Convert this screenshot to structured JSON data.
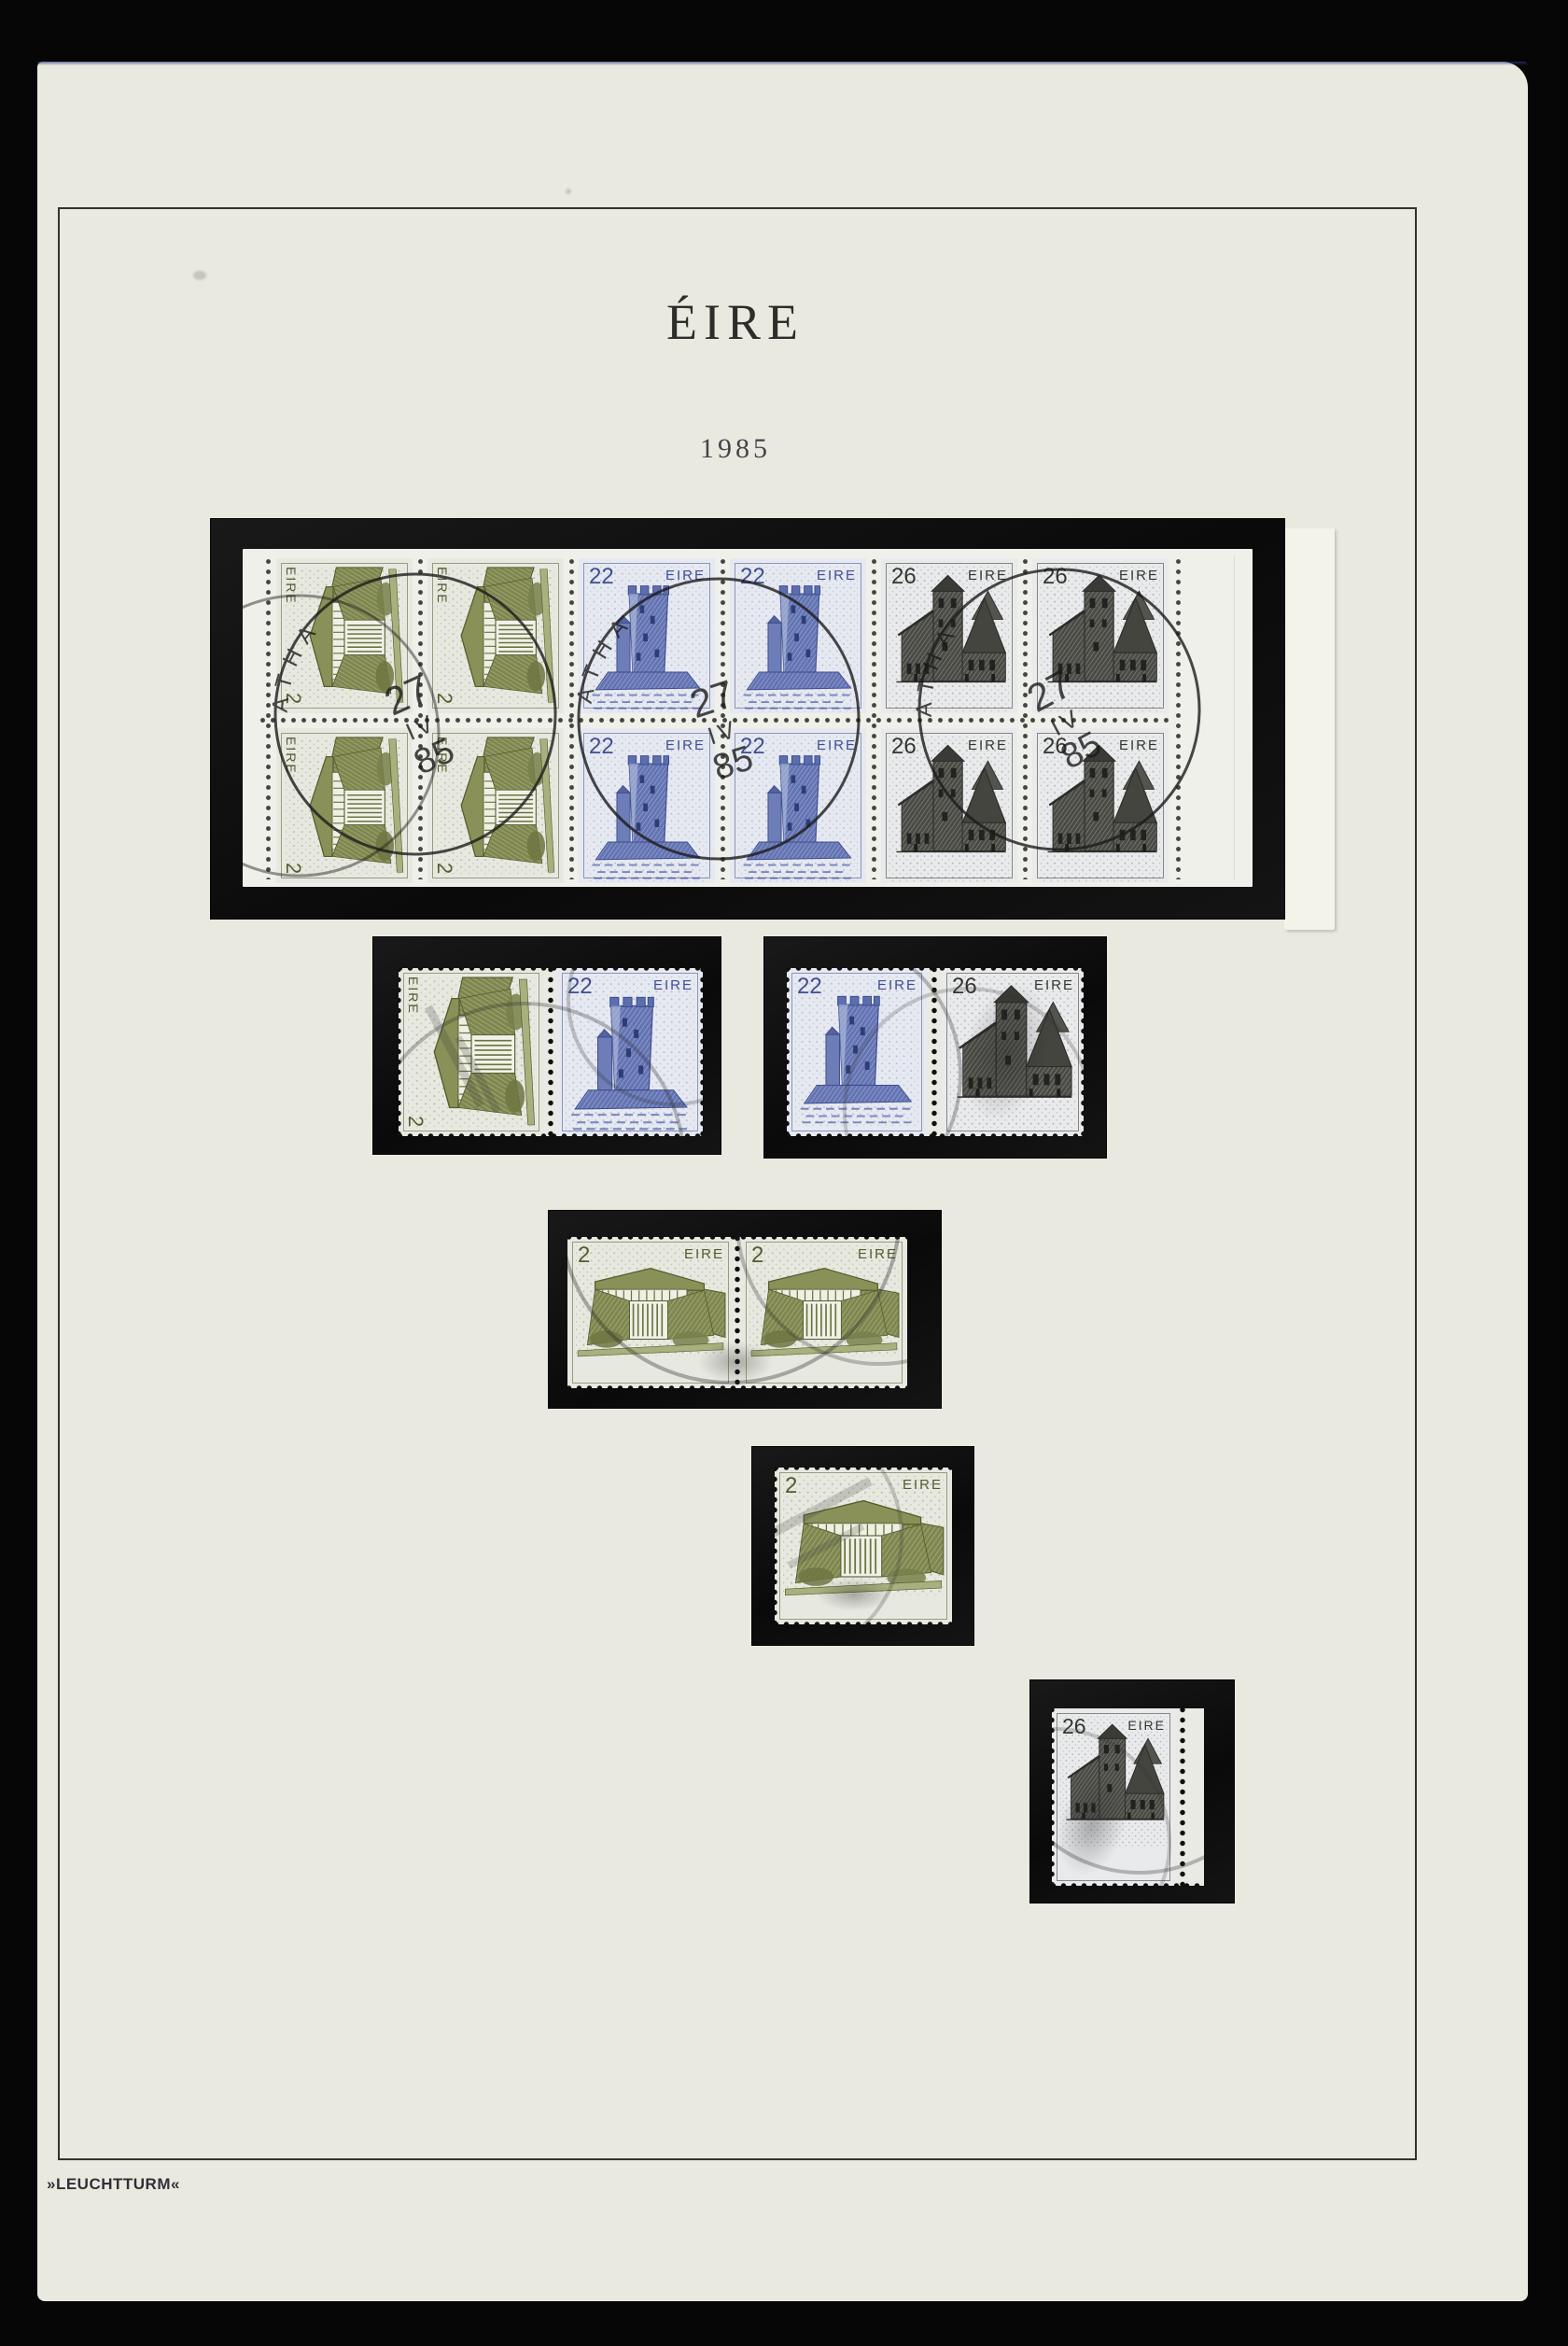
{
  "page": {
    "title": "ÉIRE",
    "year": "1985",
    "brand": "»LEUCHTTURM«"
  },
  "labels": {
    "eire": "EIRE",
    "value_2": "2",
    "value_22": "22",
    "value_26": "26"
  },
  "postmark": {
    "rim": "ATHA",
    "day": "27",
    "month": "IV",
    "year": "85"
  },
  "colors": {
    "page_paper": "#eae9e0",
    "scan_bg": "#060606",
    "mount_black": "#0e0e0e",
    "pane_white": "#eff0ea",
    "stamp_green": "#7c8349",
    "stamp_green_dark": "#565c2f",
    "stamp_blue": "#5d6eae",
    "stamp_blue_dark": "#3c4c8e",
    "stamp_gray": "#4a4a46",
    "stamp_gray_dark": "#2c2c29",
    "postmark_ink": "#1b1b1b",
    "frame_line": "#32322e"
  }
}
